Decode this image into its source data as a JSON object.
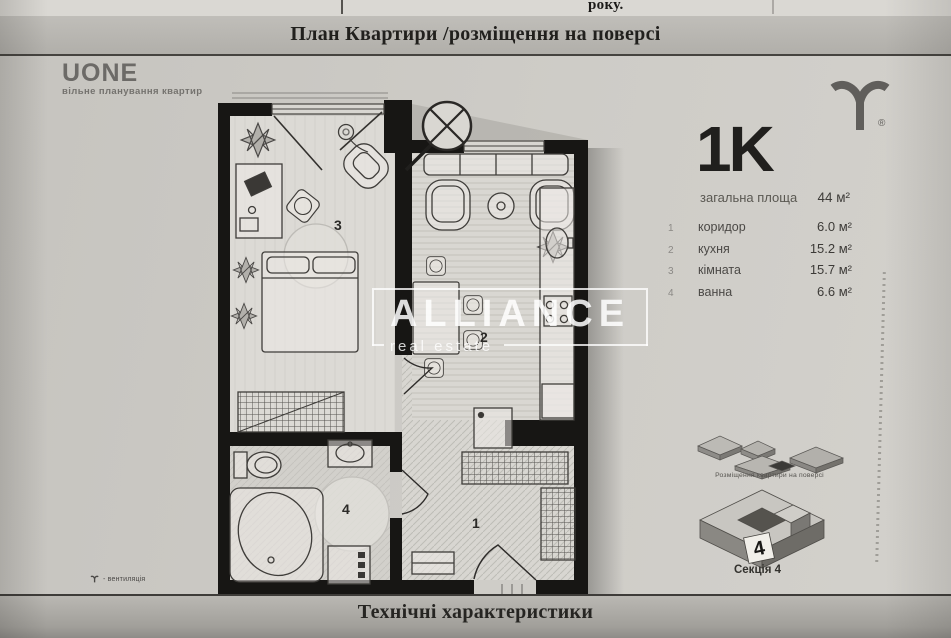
{
  "document": {
    "top_cell_text": "року.",
    "header_title": "План Квартири /розміщення на поверсі",
    "footer_title": "Технічні характеристики"
  },
  "developer": {
    "name": "UONE",
    "tagline": "вільне планування квартир",
    "registered_mark": "®"
  },
  "watermark": {
    "title": "ALLIANCE",
    "subtitle": "real estate"
  },
  "apartment": {
    "type": "1K",
    "total_area_label": "загальна площа",
    "total_area": "44 м²",
    "rooms": [
      {
        "num": "1",
        "name": "коридор",
        "area": "6.0 м²"
      },
      {
        "num": "2",
        "name": "кухня",
        "area": "15.2 м²"
      },
      {
        "num": "3",
        "name": "кімната",
        "area": "15.7 м²"
      },
      {
        "num": "4",
        "name": "ванна",
        "area": "6.6 м²"
      }
    ]
  },
  "plan": {
    "labels": {
      "corridor": "1",
      "kitchen": "2",
      "room": "3",
      "bath": "4"
    },
    "legend_ventilation": "- вентиляція"
  },
  "placement": {
    "caption": "Розміщення квартири на поверсі",
    "section_caption": "Секція 4",
    "section_number": "4"
  },
  "colors": {
    "paper": "#cbc9c4",
    "band": "#b5b3ae",
    "ink": "#1d1c1a",
    "wall": "#171614"
  }
}
